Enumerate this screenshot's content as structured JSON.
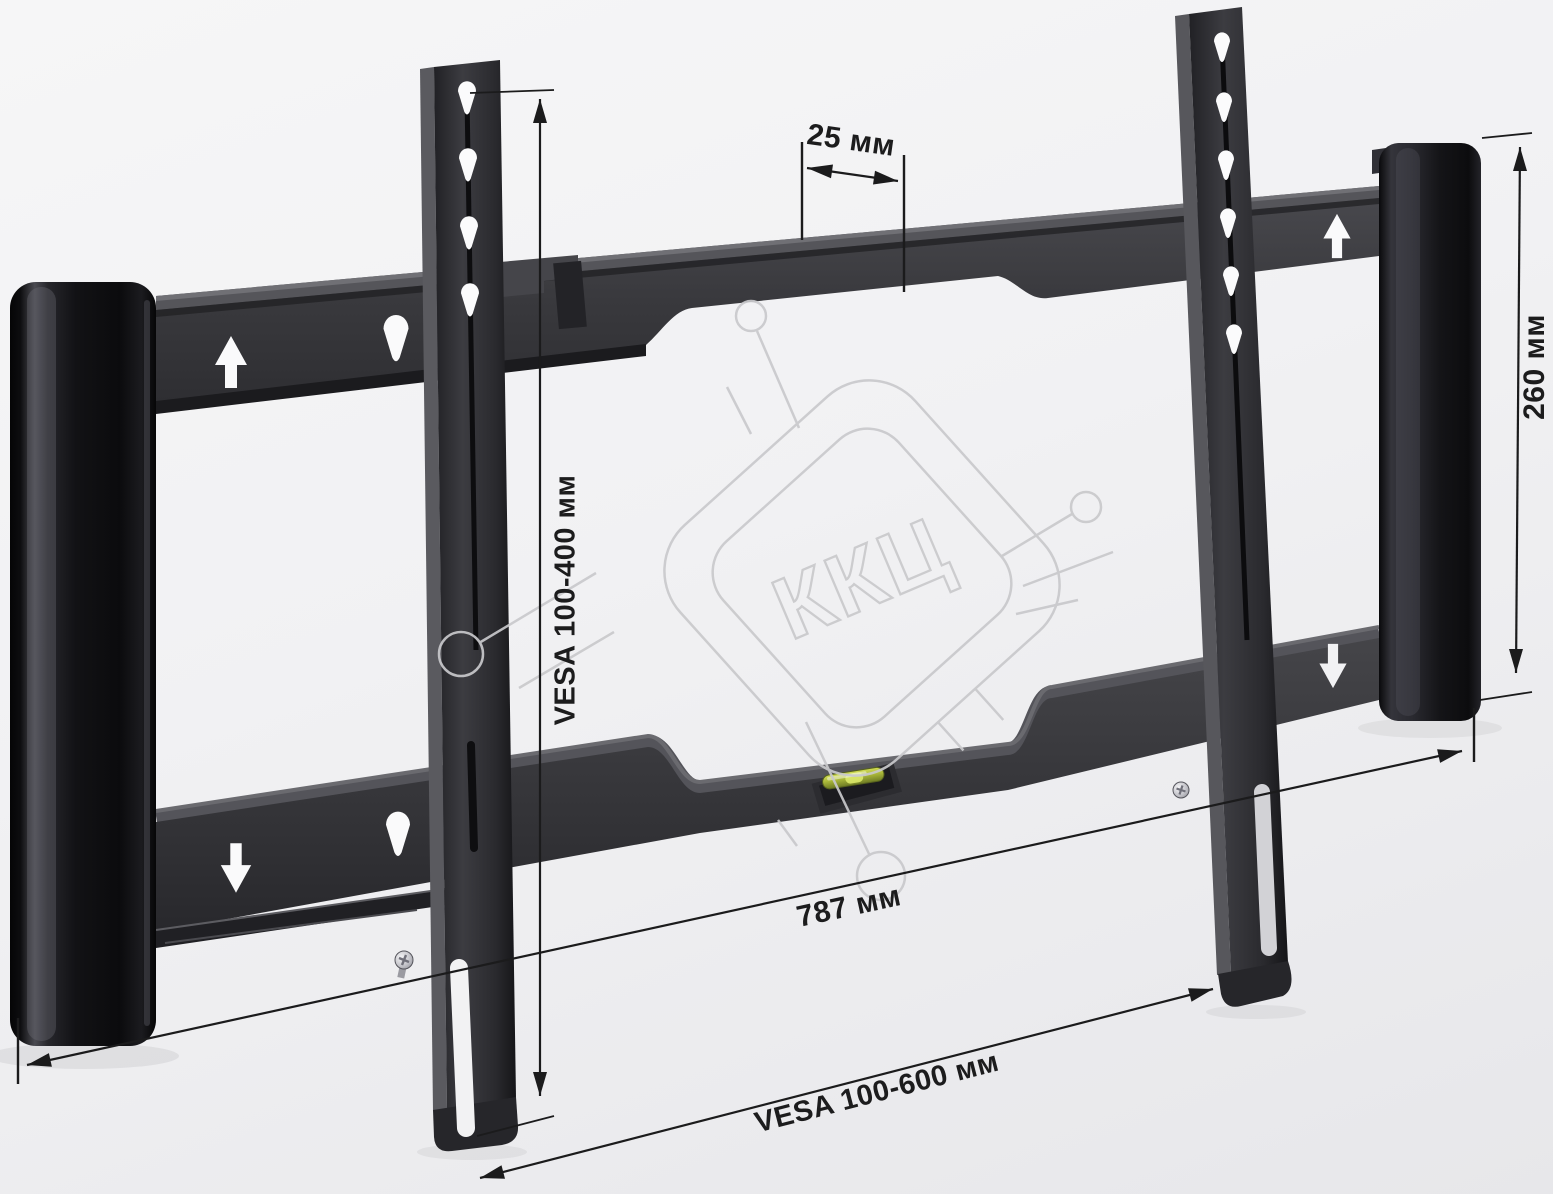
{
  "watermark": {
    "text": "ККЦ"
  },
  "dimensions": {
    "slot_pitch": {
      "label": "25 мм"
    },
    "vesa_vertical": {
      "label": "VESA 100-400 мм"
    },
    "bracket_height": {
      "label": "260 мм"
    },
    "plate_width": {
      "label": "787 мм"
    },
    "vesa_horizontal": {
      "label": "VESA 100-600 мм"
    }
  },
  "colors": {
    "background": "#f1f1f3",
    "metal_dark": "#38383c",
    "metal_black": "#0e0e10",
    "dimension_line": "#1b1b1c",
    "watermark_gray": "#c9c9cc",
    "level_vial_green": "#a9b73a"
  }
}
